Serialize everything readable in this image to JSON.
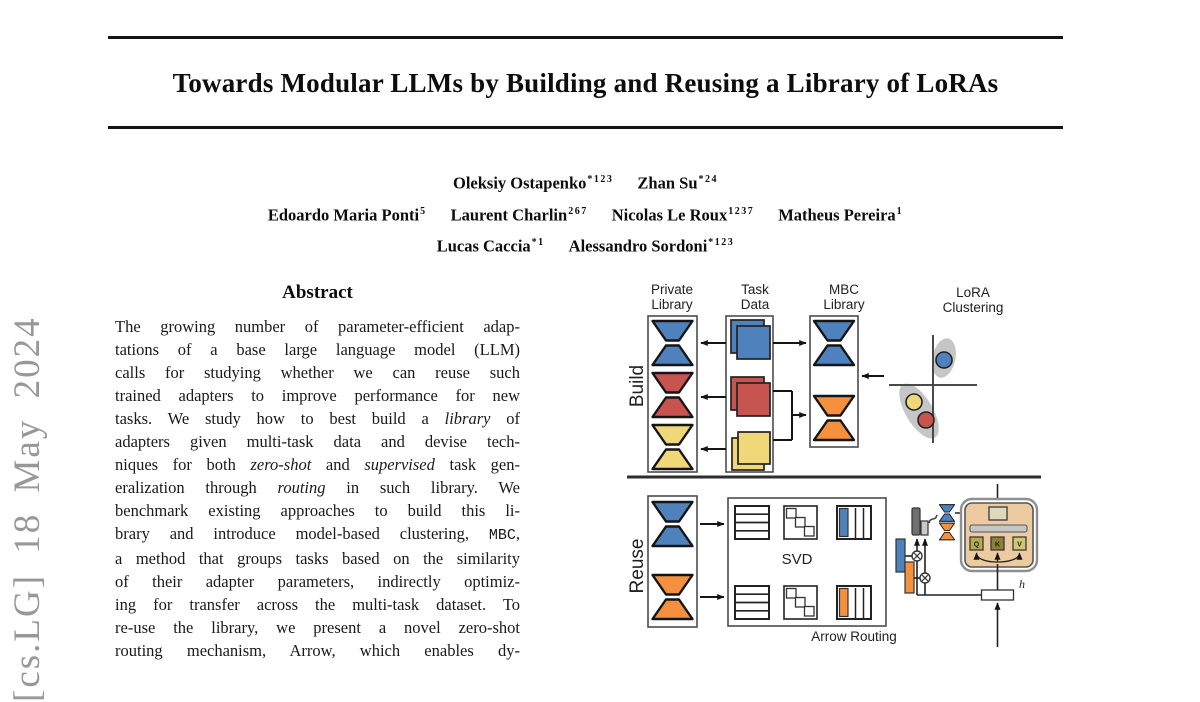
{
  "arxiv_watermark": {
    "text": "[cs.LG] 18 May 2024"
  },
  "paper": {
    "title": "Towards Modular LLMs by Building and Reusing a Library of LoRAs",
    "author_rows": [
      [
        {
          "name": "Oleksiy Ostapenko",
          "sup": "*123"
        },
        {
          "name": "Zhan Su",
          "sup": "*24"
        }
      ],
      [
        {
          "name": "Edoardo Maria Ponti",
          "sup": "5"
        },
        {
          "name": "Laurent Charlin",
          "sup": "267"
        },
        {
          "name": "Nicolas Le Roux",
          "sup": "1237"
        },
        {
          "name": "Matheus Pereira",
          "sup": "1"
        }
      ],
      [
        {
          "name": "Lucas Caccia",
          "sup": "*1"
        },
        {
          "name": "Alessandro Sordoni",
          "sup": "*123"
        }
      ]
    ],
    "abstract_heading": "Abstract",
    "abstract_lines": [
      "The growing number of parameter-efficient adap-",
      "tations of a base large language model (LLM)",
      "calls for studying whether we can reuse such",
      "trained adapters to improve performance for new",
      "tasks. We study how to best build a *library* of",
      "adapters given multi-task data and devise tech-",
      "niques for both *zero-shot* and *supervised* task gen-",
      "eralization through *routing* in such library. We",
      "benchmark existing approaches to build this li-",
      "brary and introduce model-based clustering, `MBC`,",
      "a method that groups tasks based on the similarity",
      "of their adapter parameters, indirectly optimiz-",
      "ing for transfer across the multi-task dataset. To",
      "re-use the library, we present a novel zero-shot",
      "routing mechanism, Arrow, which enables dy-"
    ]
  },
  "figure": {
    "section_build": "Build",
    "section_reuse": "Reuse",
    "labels": {
      "private": [
        "Private",
        "Library"
      ],
      "task": [
        "Task",
        "Data"
      ],
      "mbc": [
        "MBC",
        "Library"
      ],
      "lora": [
        "LoRA",
        "Clustering"
      ]
    },
    "svd": "SVD",
    "arrow_routing": "Arrow Routing",
    "h": "h",
    "qkv": [
      "Q",
      "K",
      "V"
    ]
  },
  "colors": {
    "blue": "#4f81bd",
    "red": "#c85450",
    "yellow": "#f0d878",
    "orange": "#f5913e",
    "cluster_gray": "#c6c6c6",
    "block_tan": "#edcba1",
    "watermark_gray": "#98989c"
  }
}
